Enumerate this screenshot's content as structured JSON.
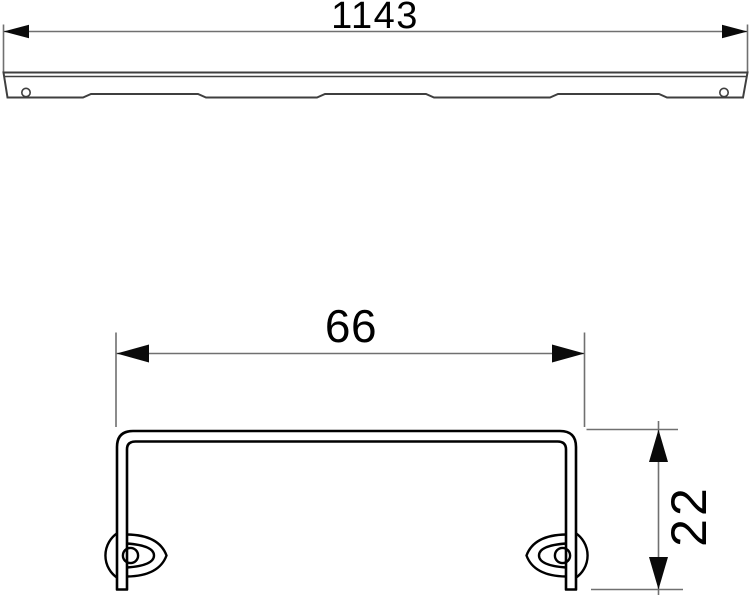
{
  "document_type": "technical-dimension-drawing",
  "views": {
    "side": {
      "name": "grate-side-view",
      "dimension_length": "1143"
    },
    "section": {
      "name": "grate-cross-section-view",
      "dimension_width": "66",
      "dimension_height": "22"
    }
  },
  "colors": {
    "background": "#ffffff",
    "profile_line": "#3f3f3f",
    "section_line": "#000000",
    "dimension_line": "#707070",
    "arrow_fill": "#0a0a0a",
    "label_text": "#000000"
  }
}
